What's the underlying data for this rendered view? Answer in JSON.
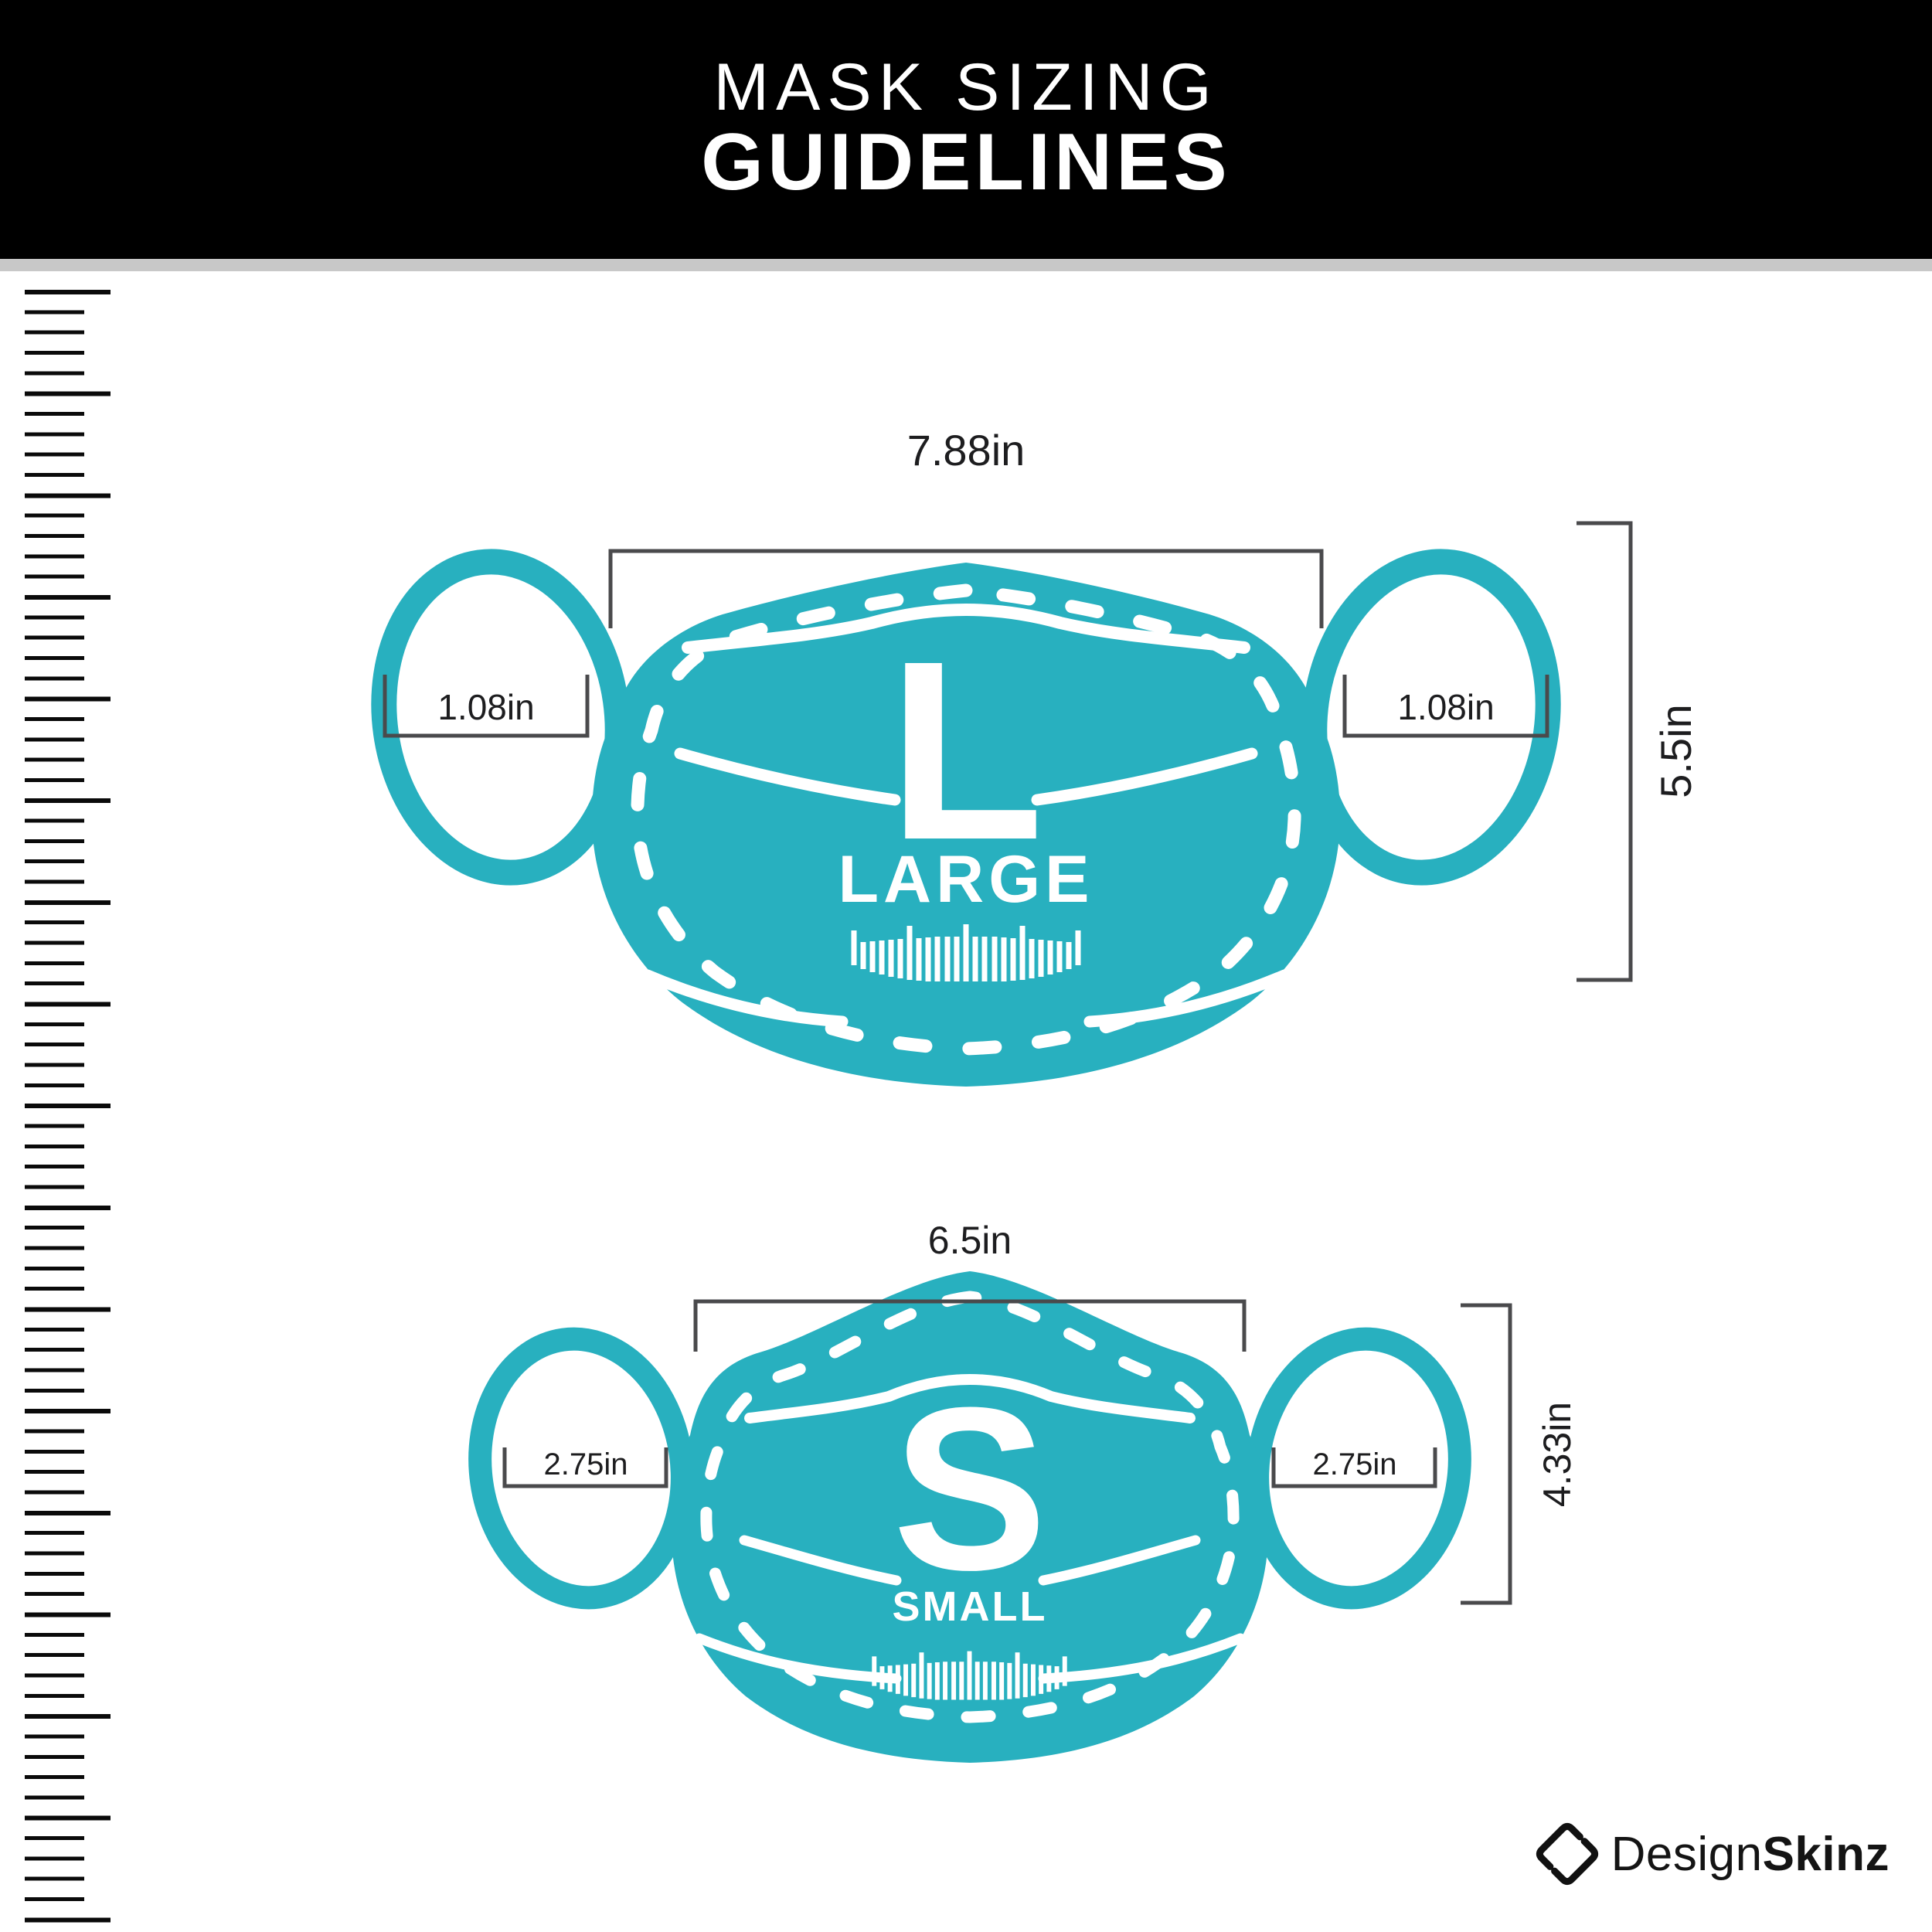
{
  "title": {
    "line1": "MASK SIZING",
    "line2": "GUIDELINES"
  },
  "masks": {
    "large": {
      "letter": "L",
      "name": "LARGE",
      "width": "7.88in",
      "height": "5.5in",
      "ear_left": "1.08in",
      "ear_right": "1.08in"
    },
    "small": {
      "letter": "S",
      "name": "SMALL",
      "width": "6.5in",
      "height": "4.33in",
      "ear_left": "2.75in",
      "ear_right": "2.75in"
    }
  },
  "brand": {
    "name_regular": "Design",
    "name_bold": "Skinz"
  },
  "icons": {
    "left_ruler_icon": "vertical ruler tick scale",
    "mask_ruler_icon": "curved ruler tick marks on mask chin",
    "brand_icon": "tilted rounded-square S mark"
  },
  "colors": {
    "mask_teal": "#28B0BF",
    "header_bg": "#000000",
    "divider_gray": "#C8C8C8",
    "dimension_line": "#4A4A4C",
    "text_dark": "#1D1D1F"
  }
}
